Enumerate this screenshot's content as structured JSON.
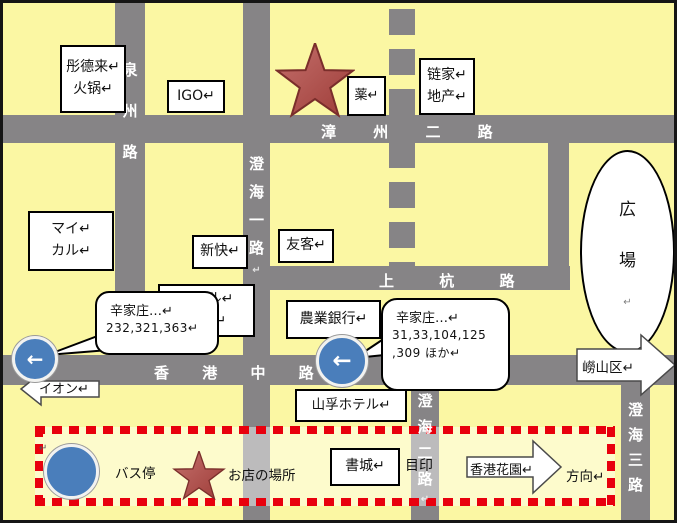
{
  "colors": {
    "background": "#FBF7A3",
    "road": "#868486",
    "frame": "#151515",
    "star_fill": "#B2504B",
    "star_edge": "#7A2E2B",
    "bus_circle_blue": "#4A7EBB",
    "legend_dash_red": "#E8000D",
    "box_background": "#FFFFFF",
    "road_label_text": "#FFFFFF"
  },
  "roads": {
    "quanzhou": {
      "label": "泉州路"
    },
    "chenghai1": {
      "label": "澄海一路↵"
    },
    "chenghai2": {
      "label": "澄海二路↵"
    },
    "chenghai3": {
      "label": "澄海三路"
    },
    "zhangzhou2": {
      "label": "漳 州 二 路"
    },
    "shanghang": {
      "label": "上 杭 路"
    },
    "hongkong": {
      "label": "香 港 中 路"
    }
  },
  "places": {
    "tongdelai": {
      "line1": "彤德来↵",
      "line2": "火锅↵"
    },
    "igo": {
      "label": "IGO↵"
    },
    "pharmacy": {
      "label": "薬↵"
    },
    "lianjia": {
      "line1": "链家↵",
      "line2": "地产↵"
    },
    "mycal": {
      "line1": "マイ↵",
      "line2": "カル↵"
    },
    "shinkai": {
      "label": "新快↵"
    },
    "yuke": {
      "label": "友客↵"
    },
    "seoul_spa": {
      "line1": "ソウル↵",
      "line2": "スパ↵"
    },
    "agri_bank": {
      "label": "農業銀行↵"
    },
    "hotel": {
      "label": "山孚ホテル↵"
    },
    "bookcity": {
      "label": "書城↵"
    },
    "plaza": {
      "label": "広場↵"
    }
  },
  "bubbles": {
    "left_bus_routes": {
      "line1": "辛家庄…↵",
      "line2": "232,321,363↵"
    },
    "right_bus_routes": {
      "line1": "辛家庄…↵",
      "line2": "31,33,104,125",
      "line3": ",309 ほか↵"
    }
  },
  "arrows": {
    "aeon": {
      "label": "イオン↵"
    },
    "laoshan": {
      "label": "嶗山区↵"
    },
    "hk_garden": {
      "label": "香港花園↵",
      "direction_label": "方向↵"
    }
  },
  "legend": {
    "bus_stop_label": "バス停",
    "shop_location_label": "お店の場所",
    "landmark_label": "目印",
    "return_mark": "↵"
  },
  "icons": {
    "bus_arrow": "←"
  }
}
